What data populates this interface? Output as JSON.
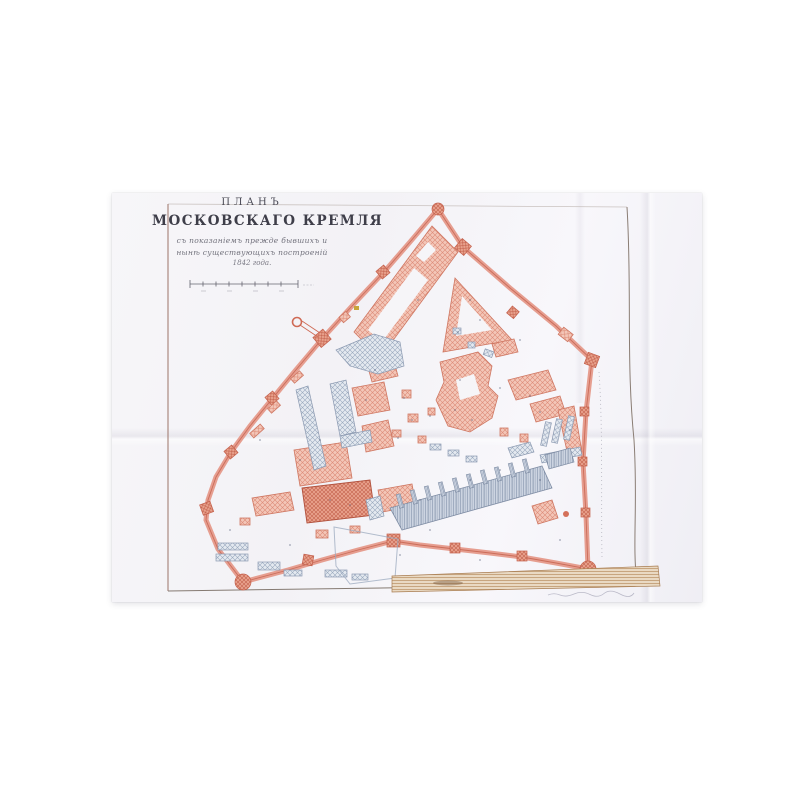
{
  "title": {
    "kicker": "ПЛАНЪ",
    "main": "МОСКОВСКАГО КРЕМЛЯ",
    "subtitle_line1": "съ показаніемъ прежде бывшихъ и",
    "subtitle_line2": "нынѣ существующихъ построеній",
    "year_line": "1842 года."
  },
  "colors": {
    "kremlin_wall_red": "#e5998a",
    "existing_buildings_red": "#dd8a76",
    "former_buildings_grey_blue": "#98a6bd",
    "embankment_tan": "#b98e62",
    "paper": "#f6f5f8",
    "neatline": "#8d8178"
  }
}
